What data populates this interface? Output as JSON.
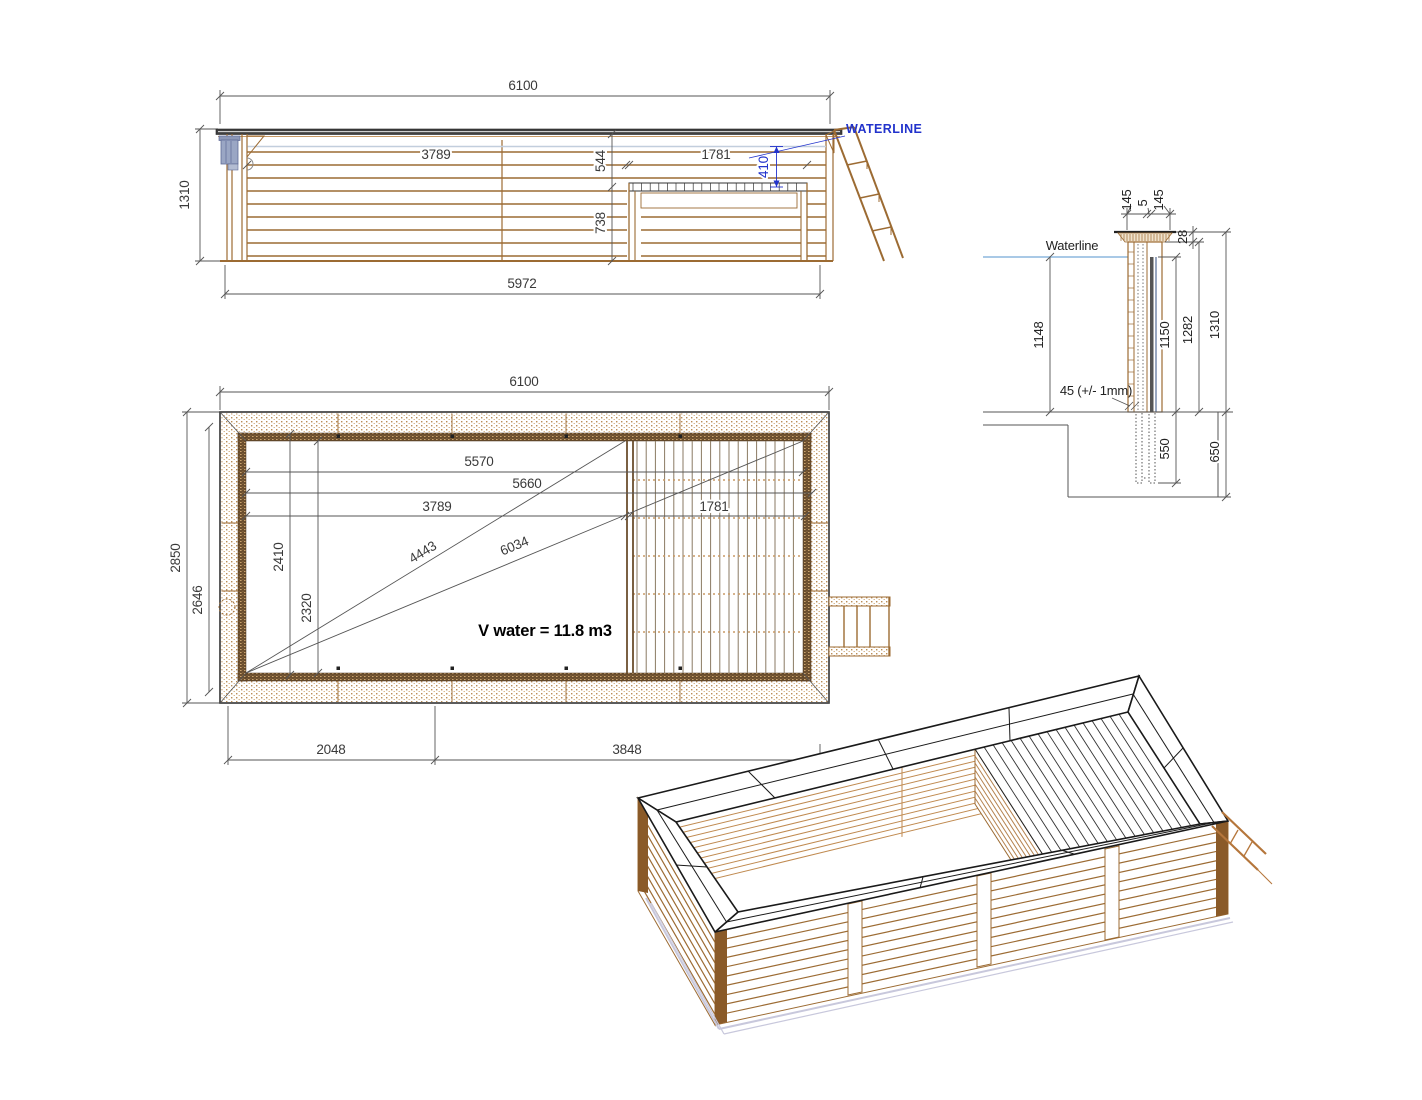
{
  "drawing_title": "Wooden pool technical drawing",
  "colors": {
    "wood_line": "#9c6b33",
    "wood_light": "#c89a66",
    "dark_line": "#2a2a2a",
    "dim_line": "#555555",
    "accent_blue": "#2233cc",
    "waterline_blue": "#a9c9e6",
    "skimmer_gray_blue": "#9aa6c4",
    "shadow_lavender": "#c8c8dc"
  },
  "elevation": {
    "dim_width_top": "6100",
    "dim_height_left": "1310",
    "dim_basin_length": "3789",
    "dim_top_to_deck": "544",
    "dim_deck_length": "1781",
    "dim_waterline_to_deck": "410",
    "dim_deck_to_floor": "738",
    "dim_width_bottom": "5972",
    "waterline_label": "WATERLINE"
  },
  "plan": {
    "dim_width_top": "6100",
    "dim_outer_width": "2850",
    "dim_axis_width": "2646",
    "dim_inner_length": "5570",
    "dim_length_5660": "5660",
    "dim_basin_length": "3789",
    "dim_deck_length": "1781",
    "dim_width_2410": "2410",
    "dim_inner_width": "2320",
    "dim_diag_basin": "4443",
    "dim_diag_full": "6034",
    "volume_label": "V water = 11.8 m3",
    "dim_bottom_left": "2048",
    "dim_bottom_right": "3848"
  },
  "section": {
    "dim_plank_left": "145",
    "dim_gap": "5",
    "dim_plank_right": "145",
    "dim_cap_thickness": "28",
    "waterline_label": "Waterline",
    "dim_water_height": "1148",
    "dim_liner_height": "1150",
    "dim_wall_height": "1282",
    "dim_total_height": "1310",
    "note_plank_thickness": "45 (+/- 1mm)",
    "dim_post_embed": "550",
    "dim_pit_depth": "650"
  }
}
